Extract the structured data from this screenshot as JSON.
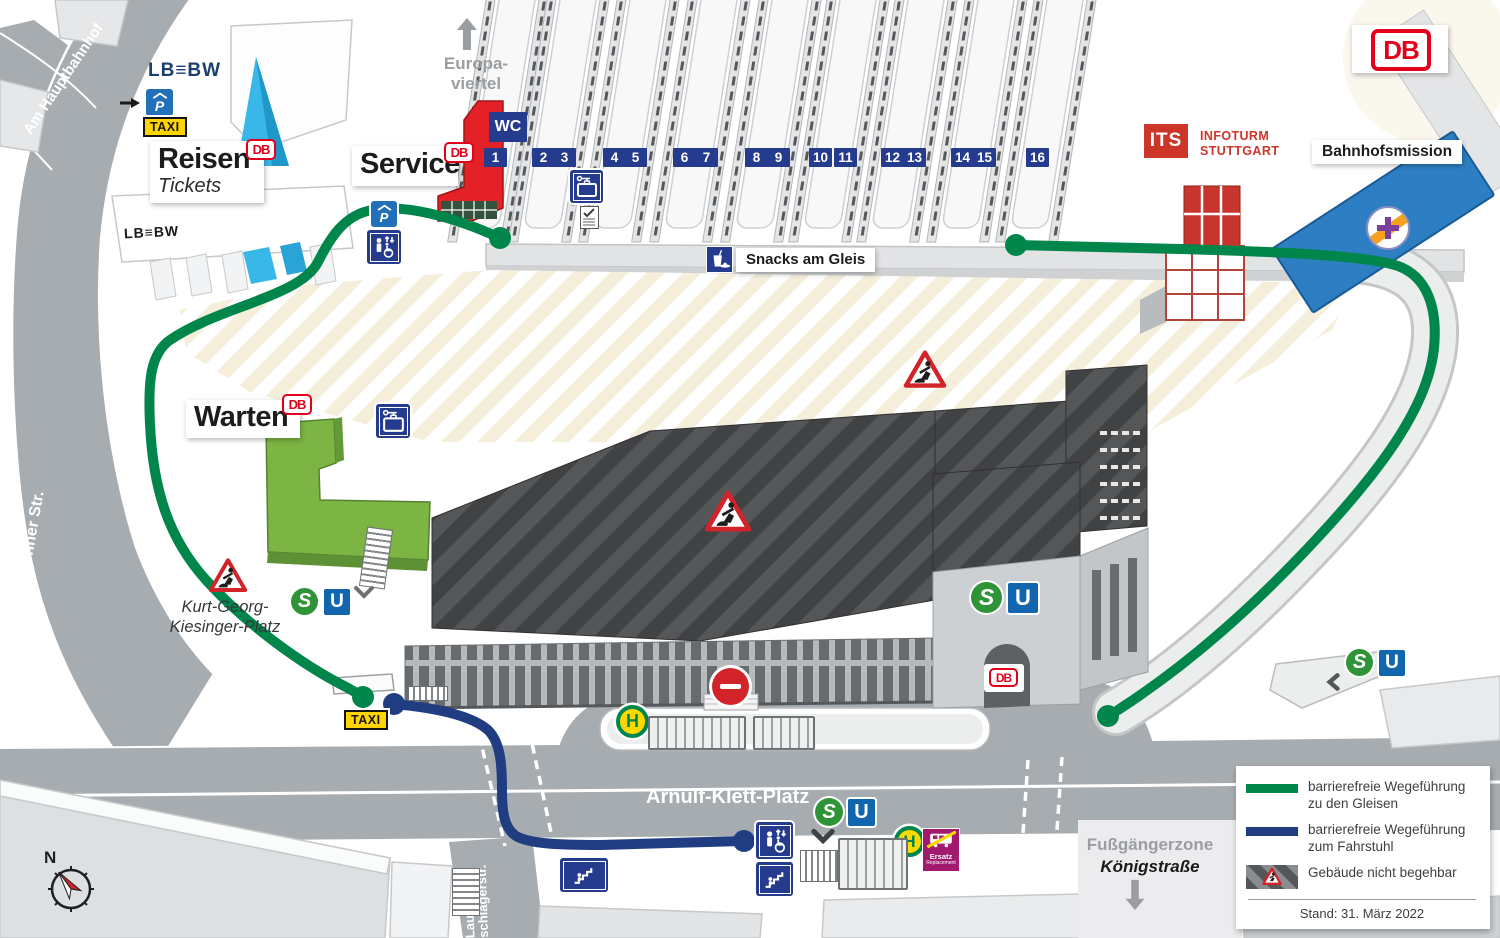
{
  "brand": {
    "db": "DB"
  },
  "compass": {
    "n": "N"
  },
  "streets": {
    "am_hauptbahnhof": "Am Hauptbahnhof",
    "heilbronner": "Heilbronner Str.",
    "arnulf": "Arnulf-Klett-Platz",
    "lauten1": "Lauten-",
    "lauten2": "schlagerstr.",
    "europa1": "Europa-",
    "europa2": "viertel",
    "fussgaengerzone": "Fußgängerzone",
    "koenigstrasse": "Königstraße",
    "kiesinger1": "Kurt-Georg-",
    "kiesinger2": "Kiesinger-Platz"
  },
  "pois": {
    "reisen": "Reisen",
    "tickets": "Tickets",
    "service": "Service",
    "warten": "Warten",
    "wc": "WC",
    "snacks": "Snacks am Gleis",
    "bahnhofsmission": "Bahnhofsmission",
    "its": "ITS",
    "infoturm1": "INFOTURM",
    "infoturm2": "STUTTGART",
    "lbbw": "LB≡BW",
    "taxi": "TAXI",
    "parking": "P",
    "ersatz": "Ersatz",
    "ersatz_sub": "Replacement"
  },
  "transit": {
    "s": "S",
    "u": "U",
    "h": "H"
  },
  "platforms": {
    "labels": [
      "1",
      "2",
      "3",
      "4",
      "5",
      "6",
      "7",
      "8",
      "9",
      "10",
      "11",
      "12",
      "13",
      "14",
      "15",
      "16"
    ]
  },
  "legend": {
    "items": [
      {
        "label": "barrierefreie Wegeführung zu den Gleisen"
      },
      {
        "label": "barrierefreie Wegeführung zum Fahrstuhl"
      },
      {
        "label": "Gebäude nicht begehbar"
      }
    ],
    "stand": "Stand: 31. März 2022"
  },
  "colors": {
    "route_green": "#00854a",
    "route_blue": "#1f3d80",
    "db_red": "#e2001a",
    "sbahn_green": "#2f9437",
    "ubahn_blue": "#1166ae",
    "h_green": "#00854d",
    "h_yellow": "#ffd800",
    "warn_red": "#d2232a",
    "building_green": "#7cb544",
    "ersatz_magenta": "#a21a6d",
    "mission_blue": "#2e7ec3",
    "lbbw_navy": "#1b3f6e",
    "sign_navy": "#253c8e",
    "taxi_yellow": "#ffd400",
    "infoturm_red": "#cd3529"
  }
}
